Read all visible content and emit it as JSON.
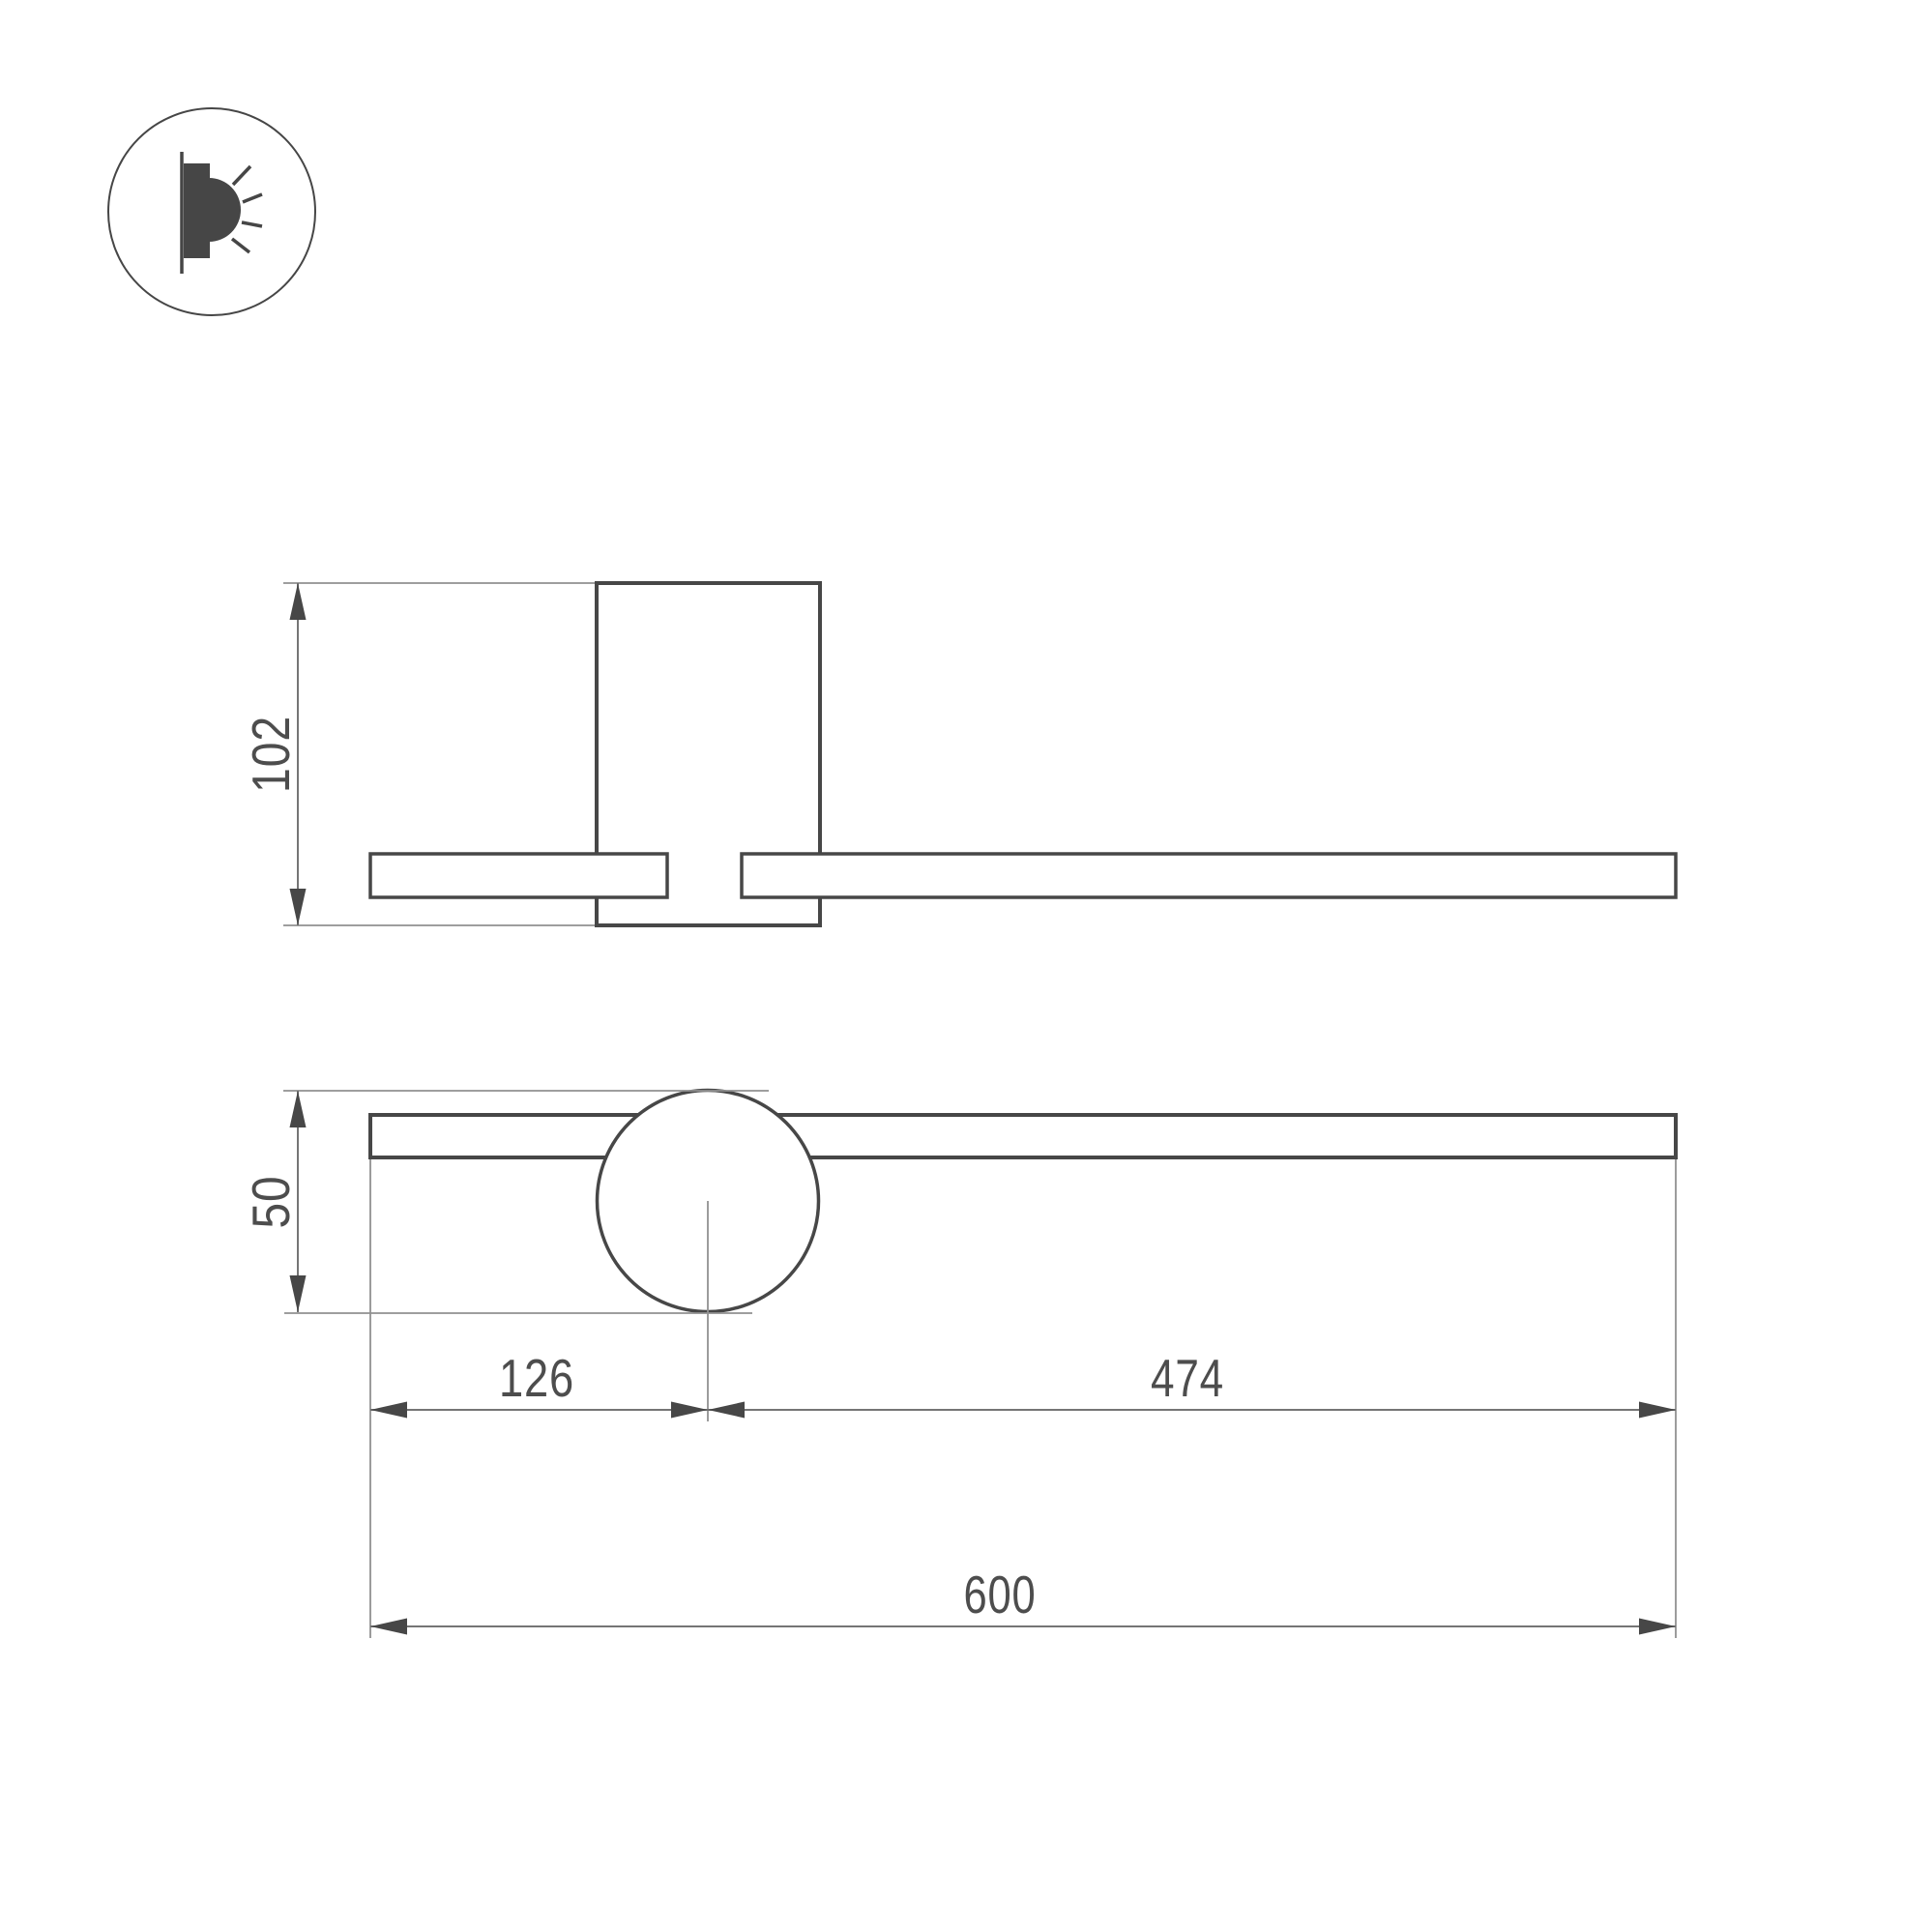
{
  "colors": {
    "outline": "#474747",
    "dim_line": "#757575",
    "extension_line": "#919191",
    "arrow": "#474747",
    "text": "#4d4d4d",
    "icon": "#464646"
  },
  "icon": {
    "name": "wall-lamp-light-icon"
  },
  "dimensions": {
    "side_height": "102",
    "front_height": "50",
    "offset_left": "126",
    "offset_right": "474",
    "total_length": "600"
  }
}
